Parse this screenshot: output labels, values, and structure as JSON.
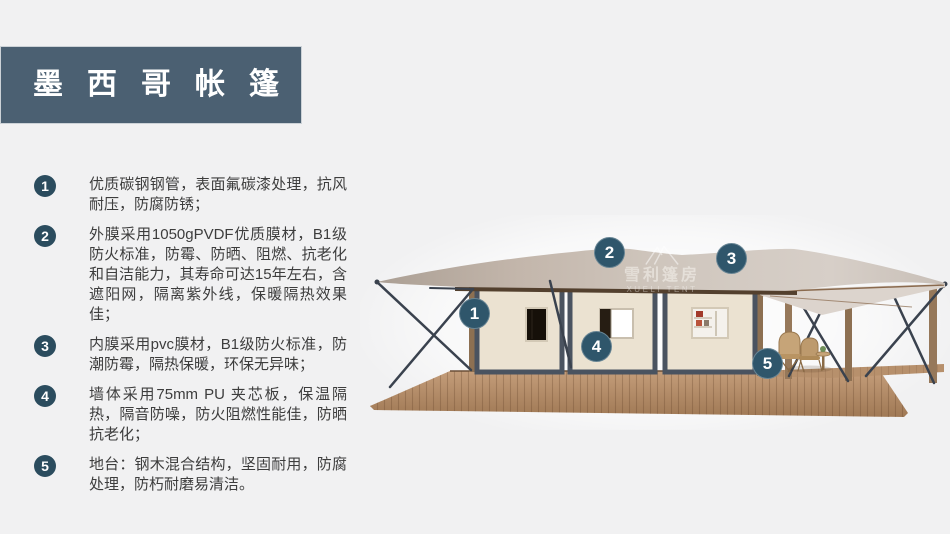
{
  "slide": {
    "background_color": "#f1f1f2"
  },
  "header": {
    "title": "墨西哥帐篷",
    "bg_color": "#4b6072",
    "text_color": "#ffffff"
  },
  "features": [
    {
      "num": "1",
      "text": "优质碳钢钢管，表面氟碳漆处理，抗风耐压，防腐防锈；"
    },
    {
      "num": "2",
      "text": "外膜采用1050gPVDF优质膜材，B1级防火标准，防霉、防晒、阻燃、抗老化和自洁能力，其寿命可达15年左右，含遮阳网，隔离紫外线，保暖隔热效果佳；"
    },
    {
      "num": "3",
      "text": "内膜采用pvc膜材，B1级防火标准，防潮防霉，隔热保暖，环保无异味；"
    },
    {
      "num": "4",
      "text": "墙体采用75mm PU 夹芯板，保温隔热，隔音防噪，防火阻燃性能佳，防晒抗老化；"
    },
    {
      "num": "5",
      "text": "地台：钢木混合结构，坚固耐用，防腐处理，防朽耐磨易清洁。"
    }
  ],
  "diagram": {
    "callouts": [
      {
        "label": "1"
      },
      {
        "label": "2"
      },
      {
        "label": "3"
      },
      {
        "label": "4"
      },
      {
        "label": "5"
      }
    ],
    "watermark": {
      "cn": "雪利篷房",
      "en": "XUELI TENT"
    },
    "colors": {
      "list_circle": "#2b4c5e",
      "callout_bg": "#2f566b",
      "roof": "#c7b9ae",
      "wall": "#ebe2d1",
      "wall_frame": "#4a5360",
      "deck": "#b18a66",
      "steel_brace": "#3a424e",
      "wood_post": "#8d7052"
    }
  }
}
